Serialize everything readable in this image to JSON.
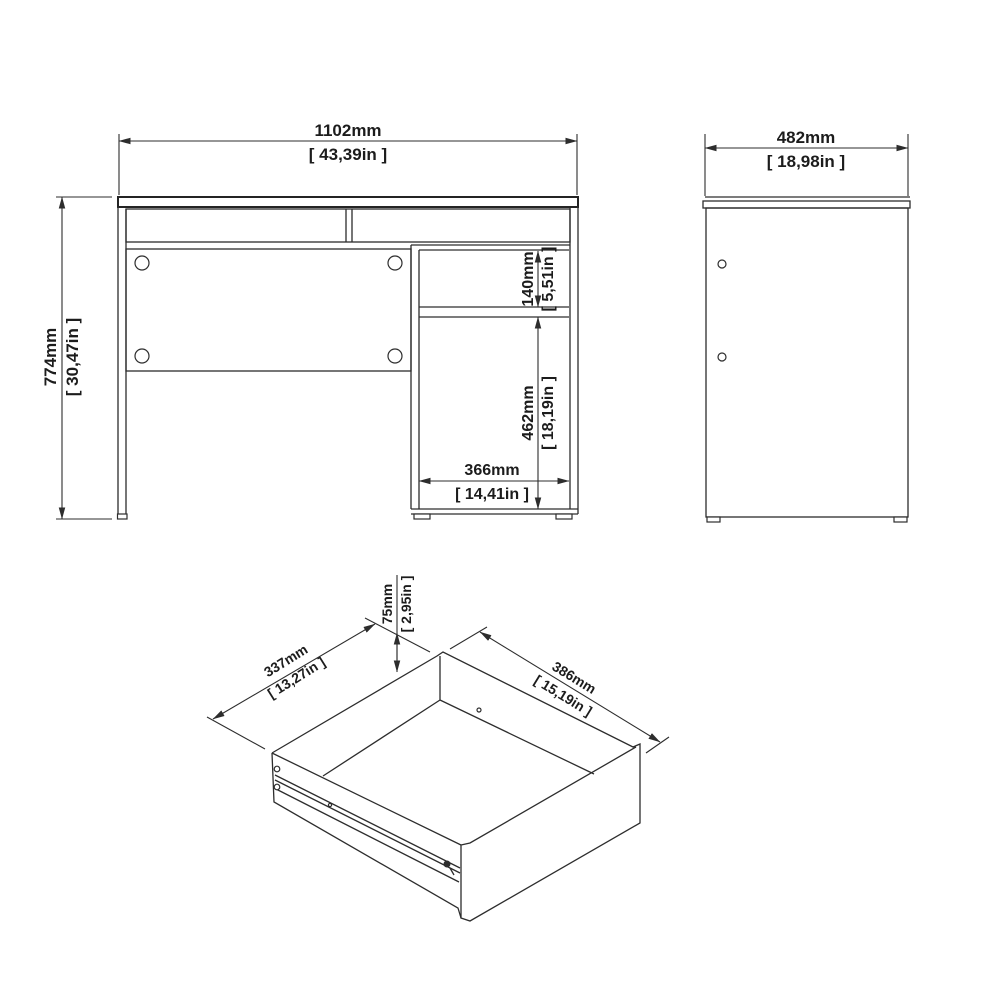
{
  "colors": {
    "background": "#ffffff",
    "line": "#2d2d2d",
    "text": "#1c1c1c"
  },
  "views": {
    "front": {
      "width_mm": "1102mm",
      "width_in": "[ 43,39in ]",
      "height_mm": "774mm",
      "height_in": "[ 30,47in ]",
      "drawer_opening_mm": "140mm",
      "drawer_opening_in": "[ 5,51in ]",
      "door_opening_mm": "462mm",
      "door_opening_in": "[ 18,19in ]",
      "inner_width_mm": "366mm",
      "inner_width_in": "[ 14,41in ]"
    },
    "side": {
      "depth_mm": "482mm",
      "depth_in": "[ 18,98in ]"
    },
    "drawer": {
      "height_mm": "75mm",
      "height_in": "[ 2,95in ]",
      "depth_mm": "337mm",
      "depth_in": "[ 13,27in ]",
      "width_mm": "386mm",
      "width_in": "[ 15,19in ]"
    }
  }
}
